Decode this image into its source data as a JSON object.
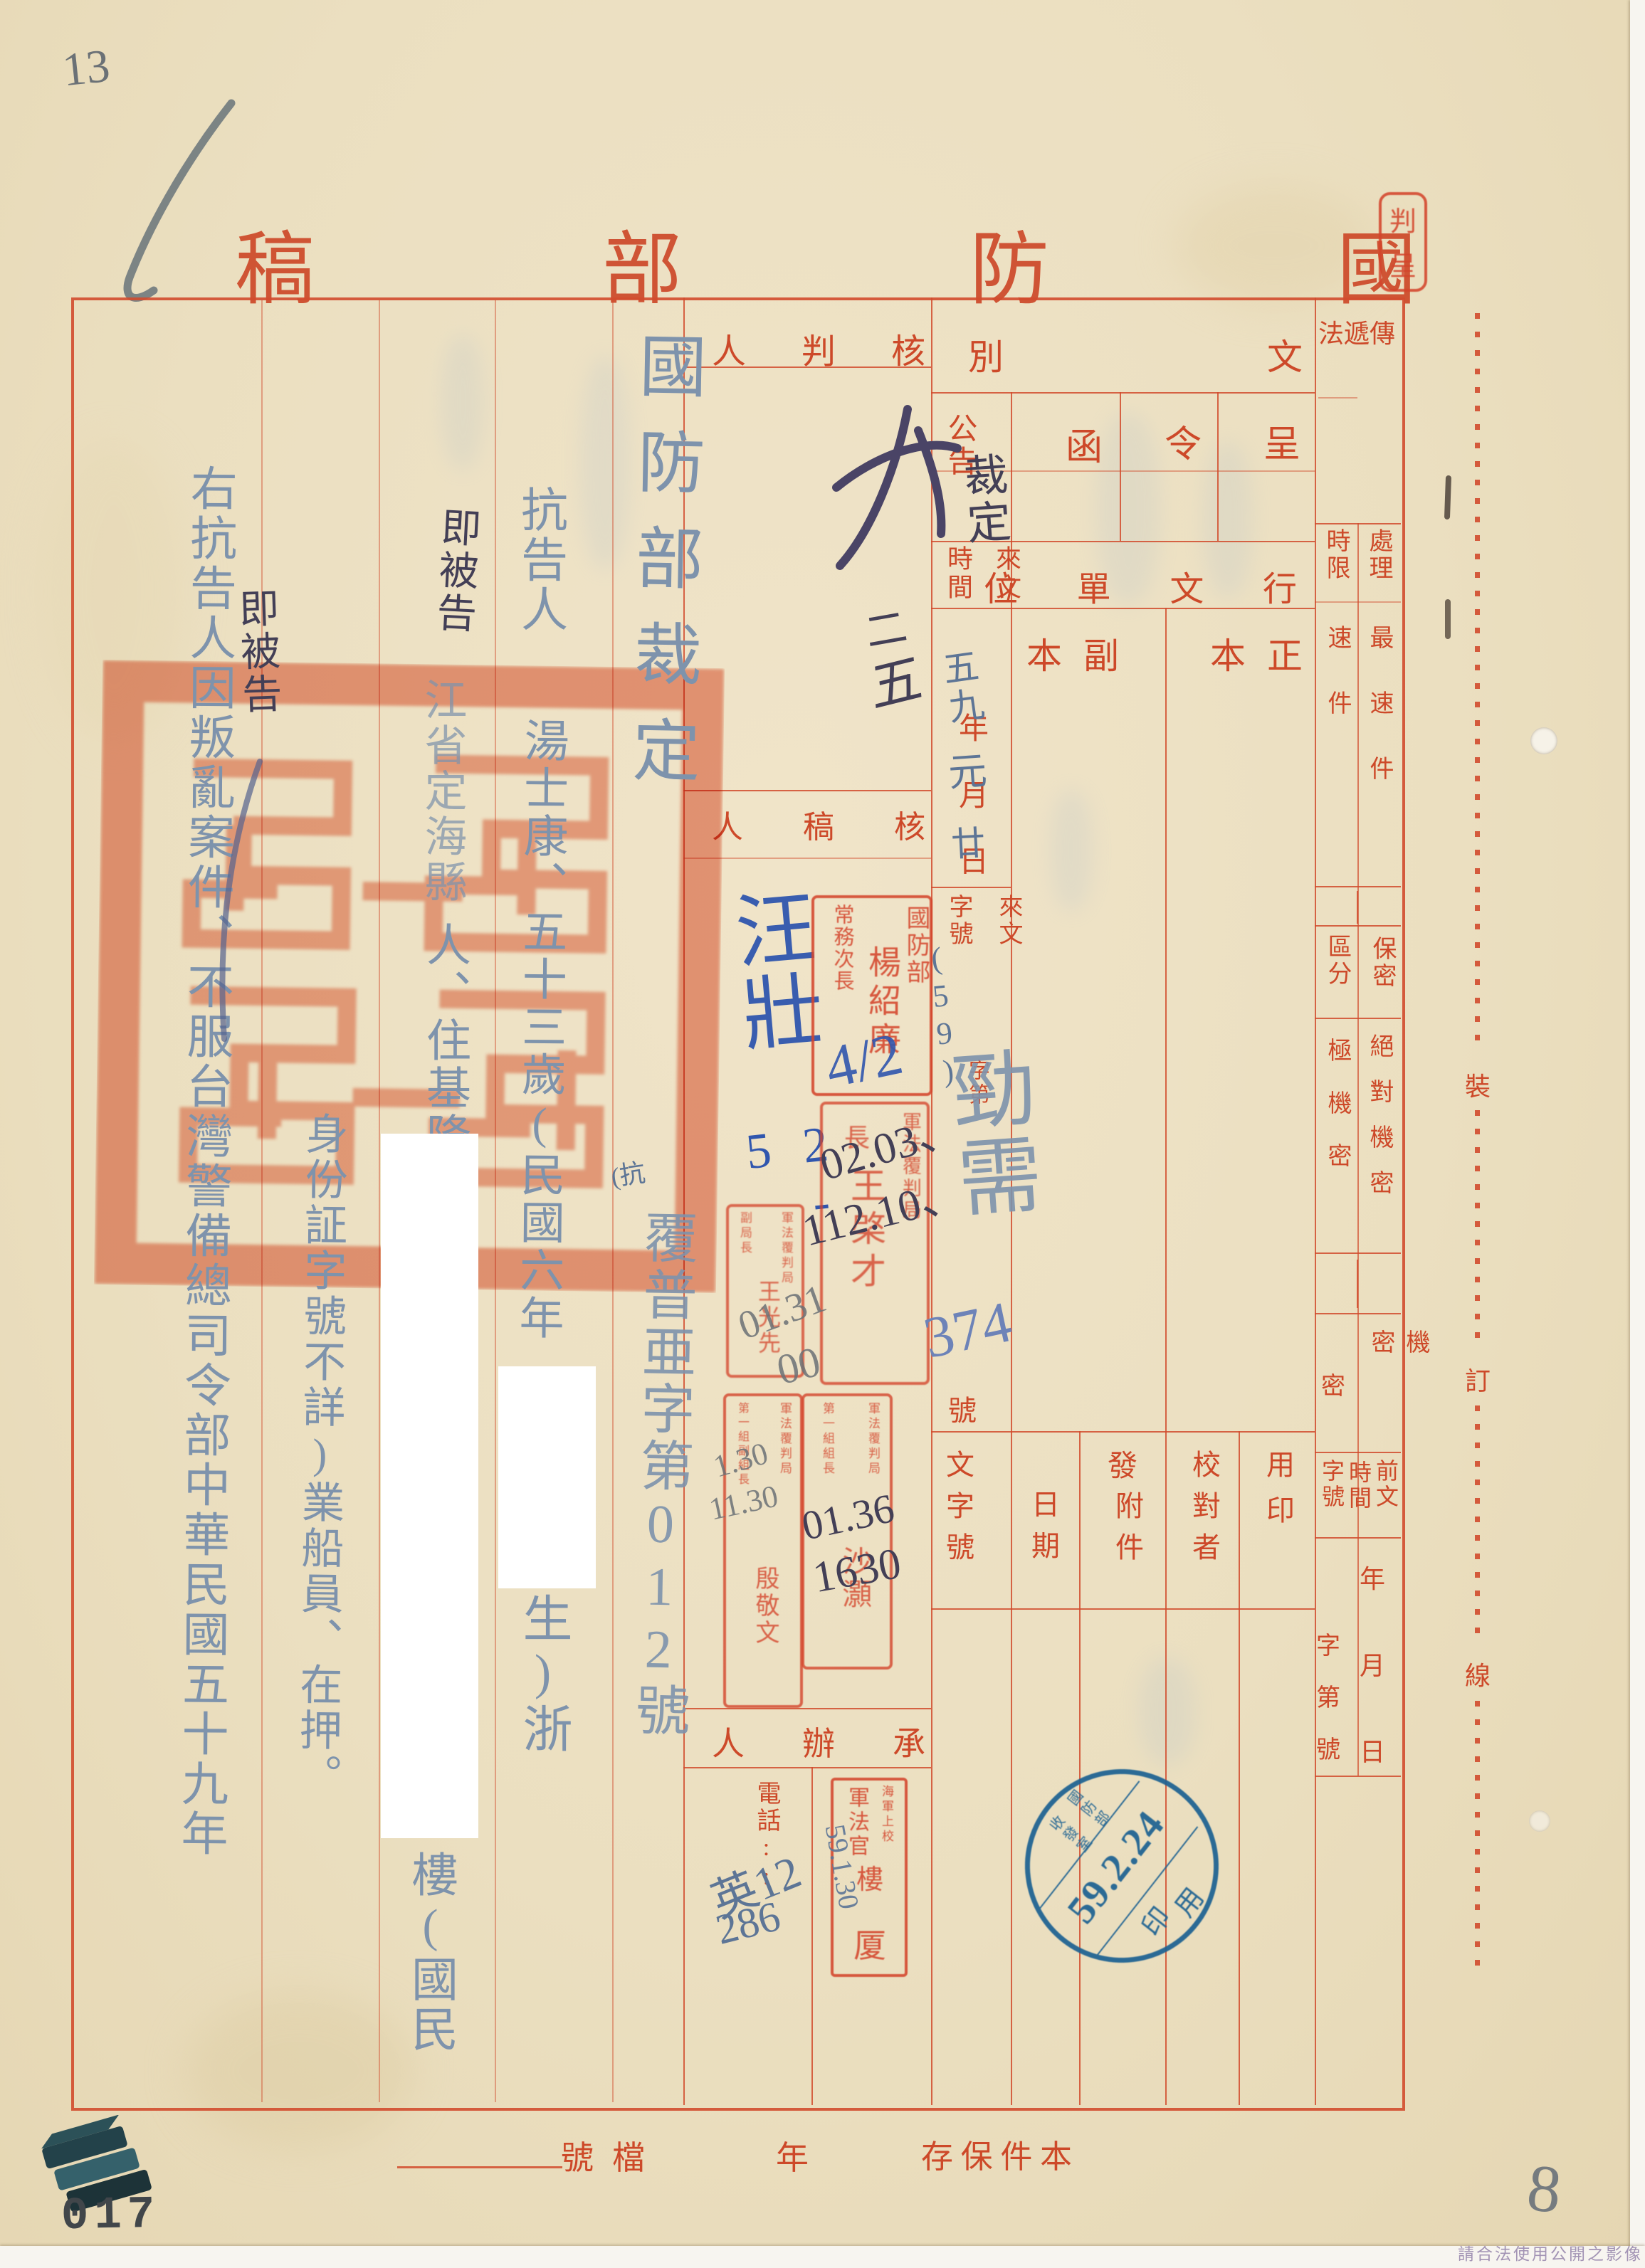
{
  "corner_notes": {
    "pencil_1": "13",
    "pencil_2": "2",
    "page_number": "8",
    "archive_number": "017",
    "watermark": "請合法使用公開之影像"
  },
  "form": {
    "title": "國防部稿",
    "top_stamp": "判呈",
    "doc_class": {
      "header": "文別",
      "cheng": "呈",
      "ling": "令",
      "han": "函",
      "gonggao": "公告"
    },
    "xingwen": {
      "header": "行文單位",
      "zhengben": "正本",
      "fuben": "副本"
    },
    "laiwen": {
      "lai_wen": "來文",
      "shi_jian": "時間",
      "zi_hao": "字號",
      "ymd": "年月日",
      "zidi": "字第",
      "hao": "號"
    },
    "fawen": {
      "wen_zi_hao": "文字號",
      "ri_qi": "日期",
      "fa": "發",
      "fu_jian": "附件",
      "jiao_dui_zhe": "校對者",
      "yong_yin": "用印"
    },
    "sections": {
      "hepanren": "核判人",
      "hegaoren": "核稿人",
      "chengbanren": "承辦人",
      "dianhua": "電話::"
    },
    "right_col": {
      "chuandifa": "傳遞法",
      "chuli": "處理",
      "shixian": "時限",
      "zuisujian": "最速件",
      "sujian": "速件",
      "baomi": "保密",
      "qufen": "區分",
      "juedui": "絕對機密",
      "jiji": "極機密",
      "jimi": "機密",
      "mi": "密",
      "qianwen": "前文",
      "shijian": "時間",
      "zihao": "字號",
      "ymd": "年月日",
      "zidihao": "字第號"
    },
    "binding_line": {
      "zhuang": "裝",
      "ding": "訂",
      "xian": "線"
    },
    "bottom": {
      "danghao": "檔號",
      "nian": "年",
      "baocun": "本件保存"
    }
  },
  "handwriting": {
    "doc_type": "裁定",
    "date_year": "五九",
    "date_month": "元",
    "date_day": "廿",
    "laiwen_no_paren": "(59)",
    "laiwen_no_chars": "勁需",
    "laiwen_no_digits": "374",
    "approval_date_1": "二",
    "approval_date_2": "五",
    "hegao_sig": "汪壯",
    "hegao_date": "2-5",
    "stamp_note": "4/2",
    "note_dark_1": "02.03、",
    "note_dark_2": "112.10、",
    "note_grey_1": "01.31",
    "note_grey_2": "00",
    "note_grey_3": "1.30",
    "note_grey_4": "11.30",
    "note_dark_3": "01.36",
    "note_dark_4": "1630",
    "phone_1": "英12",
    "phone_2": "286",
    "lou_date": "59.1.30",
    "anno_kang": "(抗"
  },
  "body": {
    "c1_title": "國防部裁定",
    "c1_caseno": "覆普亜字第012號",
    "c2_role": "抗告人",
    "c2_person": "湯士康、五十三歲(民國六年",
    "c2_tail": "生)浙",
    "c3_note": "即被告",
    "c3_a": "江省定海縣",
    "c3_b": "人、住基隆市",
    "c3_c": "樓(國民",
    "c4": "身份証字號不詳)業船員、在押。",
    "c5": "右抗告人因叛亂案件、不服台灣警備總司令部中華民國五十九年",
    "c5_note": "即被告"
  },
  "stamps": {
    "yang": {
      "org": "國防部",
      "role": "常務次長",
      "name": "楊紹廉"
    },
    "juzhang": {
      "org": "軍法覆判局",
      "role": "長",
      "name": "王棨才"
    },
    "fujuzhang": {
      "org": "軍法覆判局",
      "role": "副局長",
      "name": "王光先"
    },
    "zuzhang": {
      "org": "軍法覆判局",
      "role": "第一組組長",
      "name": "沙灝"
    },
    "fuzuzhang": {
      "org": "軍法覆判局",
      "role": "第一組副組長",
      "name": "殷敬文"
    },
    "lou": {
      "rank": "海軍上校",
      "role": "軍法官",
      "name1": "樓",
      "name2": "厦"
    },
    "blue_round": {
      "org": "國防部",
      "office": "收發室",
      "date": "59.2.24",
      "yin": "印",
      "yong": "用"
    }
  }
}
